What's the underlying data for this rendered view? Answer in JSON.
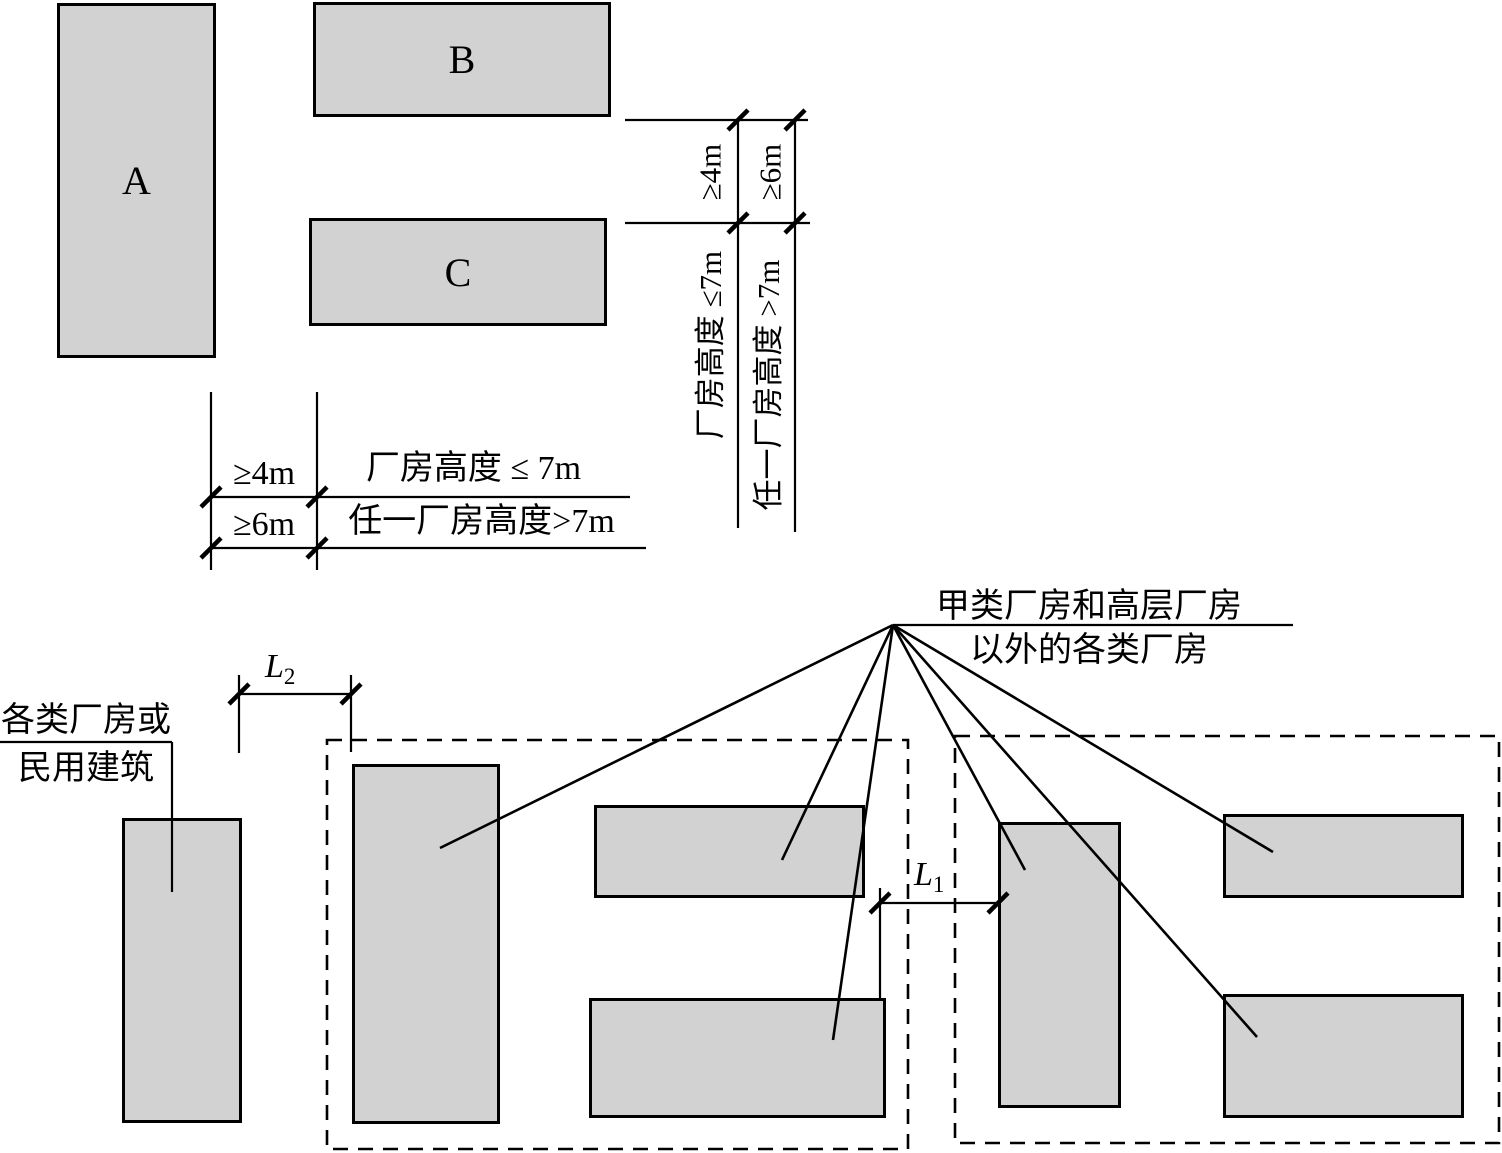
{
  "colors": {
    "building_fill": "#d2d2d2",
    "line": "#000000",
    "background": "#ffffff"
  },
  "top_group": {
    "building_a": "A",
    "building_b": "B",
    "building_c": "C",
    "dim1_value": "≥4m",
    "dim1_condition": "厂房高度 ≤7m",
    "dim2_value": "≥6m",
    "dim2_condition": "任一厂房高度 >7m"
  },
  "legend": {
    "row1_spacing": "≥4m",
    "row1_condition": "厂房高度 ≤ 7m",
    "row2_spacing": "≥6m",
    "row2_condition": "任一厂房高度>7m"
  },
  "bottom_group": {
    "left_label_line1": "各类厂房或",
    "left_label_line2": "民用建筑",
    "right_label_line1": "甲类厂房和高层厂房",
    "right_label_line2": "以外的各类厂房",
    "l1_base": "L",
    "l1_sub": "1",
    "l2_base": "L",
    "l2_sub": "2"
  }
}
